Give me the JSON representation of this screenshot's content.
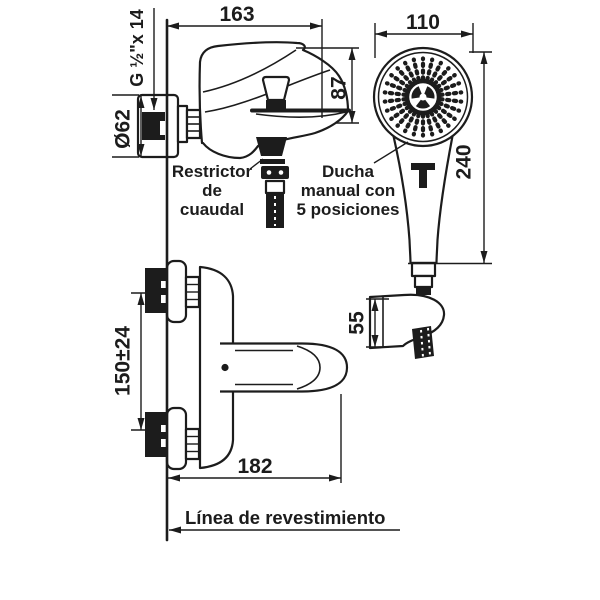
{
  "diagram": {
    "dimensions": {
      "mixer_width": "163",
      "mixer_height": "87",
      "head_width": "110",
      "shower_length": "240",
      "holder_height": "55",
      "supply_spacing": "150±24",
      "mixer_total_width": "182",
      "escutcheon_diameter": "Ø62",
      "thread_spec": "G ½\"x 14"
    },
    "labels": {
      "flow_restrictor": [
        "Restrictor",
        "de",
        "cuaudal"
      ],
      "hand_shower": [
        "Ducha",
        "manual con",
        "5 posiciones"
      ],
      "wall_finish_line": "Línea de revestimiento"
    },
    "colors": {
      "ink": "#1c1c1c",
      "background": "#ffffff"
    }
  }
}
